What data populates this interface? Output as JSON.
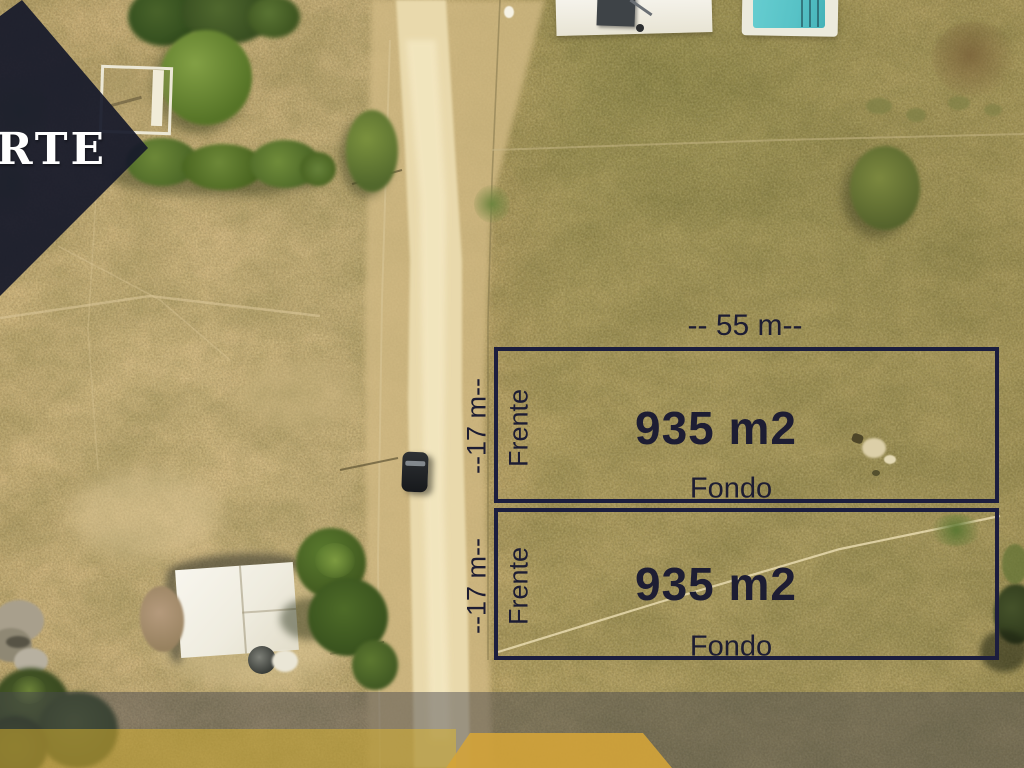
{
  "watermark": {
    "corner_text": "RTE"
  },
  "annotation": {
    "lot1": {
      "width_label": "-- 55 m--",
      "depth_label": "--17 m--",
      "front_label": "Frente",
      "area_label": "935 m2",
      "back_label": "Fondo"
    },
    "lot2": {
      "depth_label": "--17 m--",
      "front_label": "Frente",
      "area_label": "935 m2",
      "back_label": "Fondo"
    }
  },
  "colors": {
    "lot_outline_navy": "#1c1e3e",
    "label_text": "#1d1d33",
    "brand_navy": "#161a2a",
    "brand_gold": "#d4a438"
  }
}
